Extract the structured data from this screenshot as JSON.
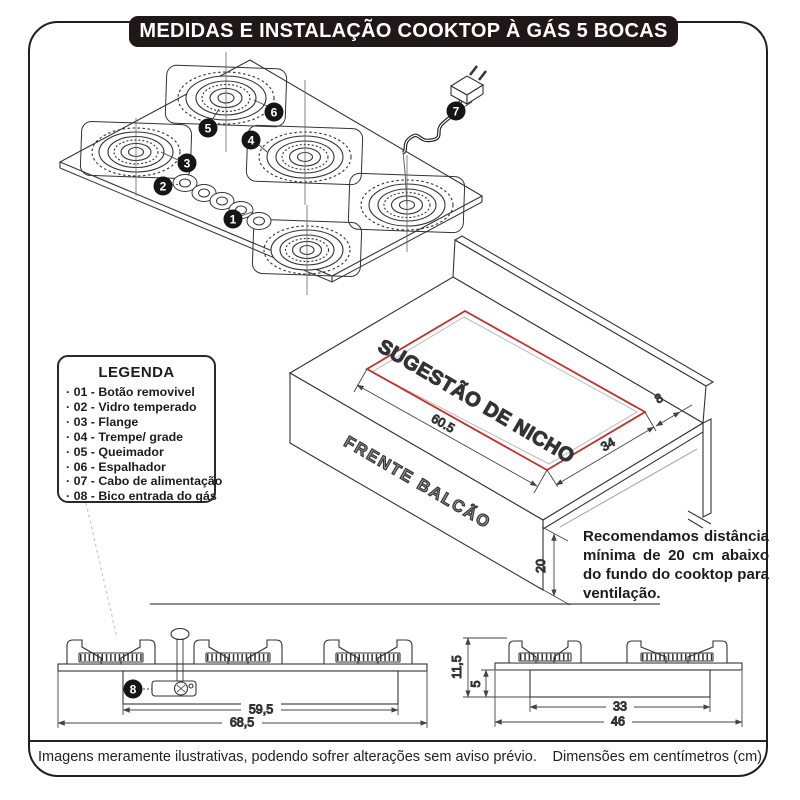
{
  "title_bar": {
    "title": "MEDIDAS E INSTALAÇÃO COOKTOP À GÁS 5 BOCAS"
  },
  "legend": {
    "title": "LEGENDA",
    "items": [
      "· 01 - Botão removivel",
      "· 02 - Vidro temperado",
      "· 03 - Flange",
      "· 04 - Trempe/ grade",
      "· 05 - Queimador",
      "· 06 - Espalhador",
      "· 07 - Cabo de alimentação",
      "· 08 - Bico entrada do gás"
    ]
  },
  "callouts": {
    "c1": "1",
    "c2": "2",
    "c3": "3",
    "c4": "4",
    "c5": "5",
    "c6": "6",
    "c7": "7",
    "c8": "8"
  },
  "niche": {
    "label": "SUGESTÃO DE NICHO",
    "width": "60.5",
    "depth": "34",
    "gap_to_wall": "8",
    "counter_front_label": "FRENTE BALCÃO",
    "clearance_below": "20"
  },
  "recommendation": {
    "text": "Recomendamos distância mínima de 20 cm abaixo do fundo do cooktop para ventilação."
  },
  "front_view": {
    "inner_width": "59,5",
    "outer_width": "68,5"
  },
  "side_view": {
    "total_height": "11,5",
    "box_depth": "5",
    "box_width": "33",
    "total_width": "46"
  },
  "footer": {
    "left": "Imagens meramente ilustrativas, podendo sofrer alterações sem aviso prévio.",
    "right": "Dimensões em centímetros (cm)"
  },
  "colors": {
    "accent_red": "#c2302e",
    "title_bg": "#201818",
    "label_gray": "#8f8f8f"
  }
}
